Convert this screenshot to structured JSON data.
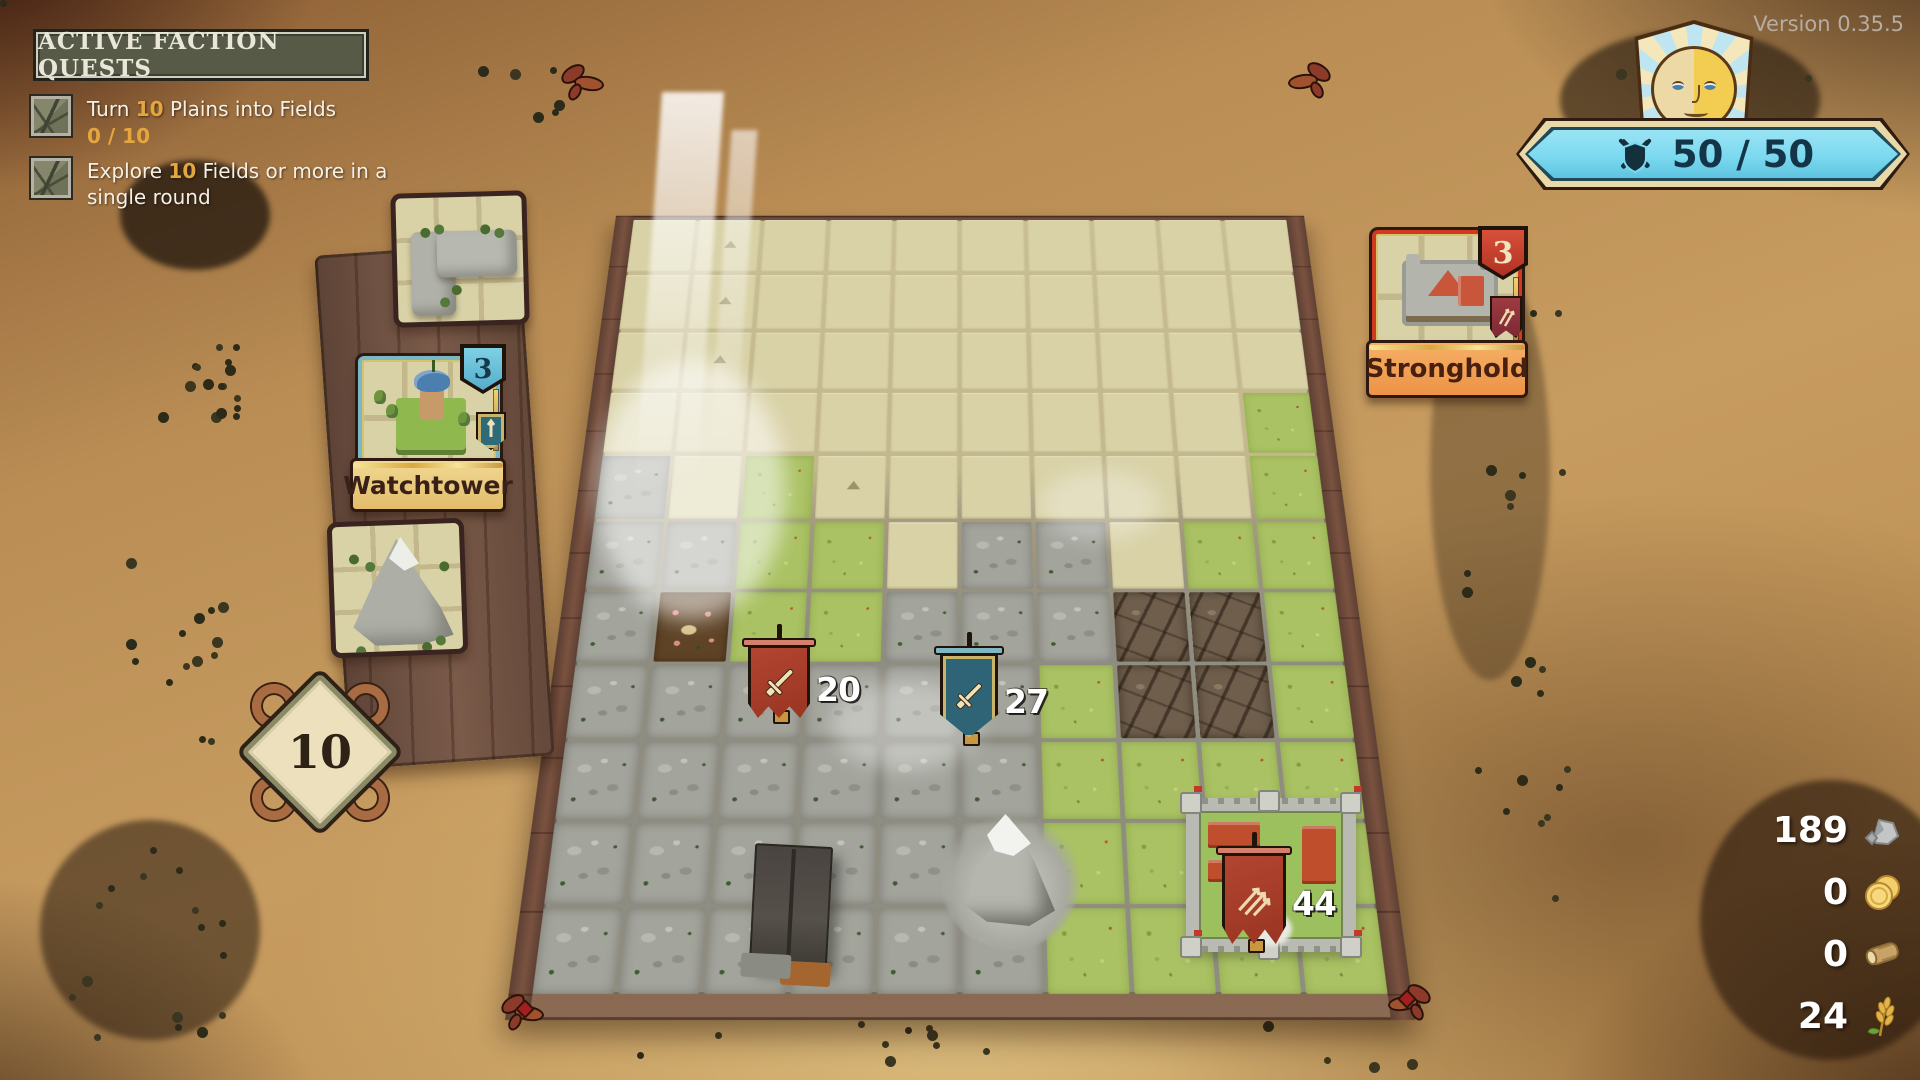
{
  "version_label": "Version 0.35.5",
  "quest_panel": {
    "title": "ACTIVE FACTION QUESTS",
    "items": [
      {
        "prefix": "Turn ",
        "amount": "10",
        "suffix": " Plains into Fields",
        "progress": "0 / 10"
      },
      {
        "prefix": "Explore ",
        "amount": "10",
        "suffix": " Fields or more in a single round"
      }
    ]
  },
  "morale": {
    "value": "50 / 50"
  },
  "round_marker": {
    "value": "10"
  },
  "hand": {
    "cards": [
      {
        "name": "Watchtower",
        "count": "3",
        "accent": "#6cc0d8"
      },
      {
        "name": "Stronghold",
        "count": "3",
        "accent": "#d03a22"
      }
    ]
  },
  "units": [
    {
      "label": "20",
      "style": "banner-red",
      "icon": "sword",
      "x": 748,
      "y": 640,
      "w": 62,
      "h": 78
    },
    {
      "label": "27",
      "style": "shield-teal",
      "icon": "sword",
      "x": 940,
      "y": 648,
      "w": 58,
      "h": 90
    },
    {
      "label": "44",
      "style": "banner-red",
      "icon": "arrows",
      "x": 1222,
      "y": 848,
      "w": 64,
      "h": 96
    }
  ],
  "resources": [
    {
      "value": "189",
      "icon": "stone"
    },
    {
      "value": "0",
      "icon": "coins"
    },
    {
      "value": "0",
      "icon": "log"
    },
    {
      "value": "24",
      "icon": "wheat"
    }
  ],
  "board": {
    "rows": [
      "FFFFFFFFFF",
      "FFFFFFFFFF",
      "FFFFFFFFFF",
      "FFFFFFFFFG",
      "RFGFFFFFFG",
      "RRGGFRRFGG",
      "RDGGRRRCCG",
      "RRRRRRGCCG",
      "RRRRRRGGGG",
      "RRRRRMGGGG",
      "RRRRRRGGGG"
    ],
    "legend": {
      "F": "unexplored",
      "G": "grass",
      "R": "rock",
      "D": "dirt",
      "C": "crevice",
      "M": "mountain"
    },
    "markers": [
      [
        0,
        1
      ],
      [
        1,
        1
      ],
      [
        2,
        1
      ],
      [
        4,
        3
      ]
    ]
  }
}
